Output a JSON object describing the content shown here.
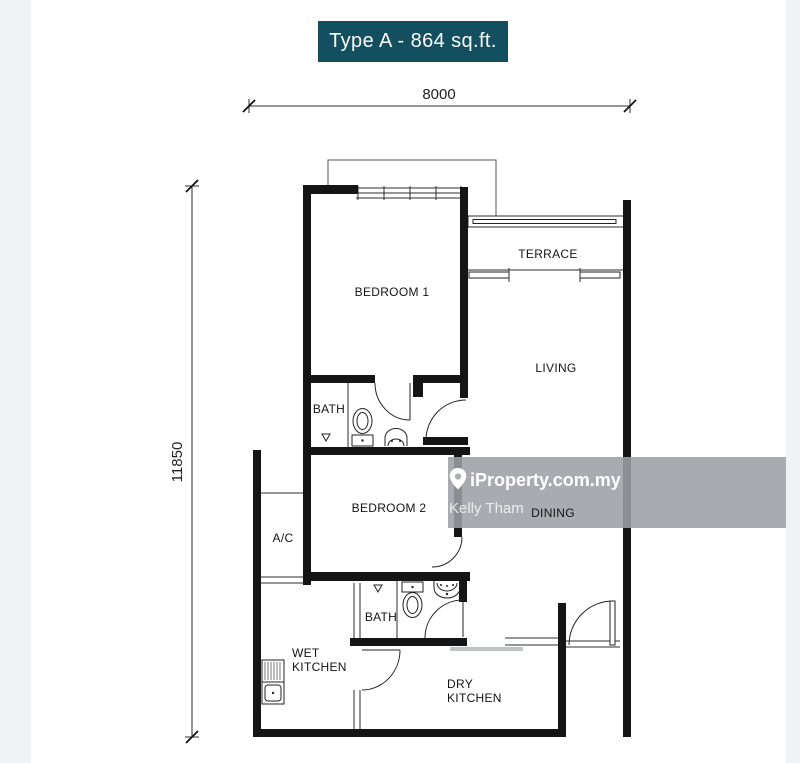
{
  "page": {
    "background_color": "#ffffff",
    "gutter_color": "#f1f2f4"
  },
  "title_badge": {
    "label": "Type A - 864 sq.ft.",
    "background_color": "#134f5e",
    "text_color": "#ffffff"
  },
  "dimension_labels": {
    "top_width": "8000",
    "left_height": "11850"
  },
  "plan_labels": {
    "bedroom_1": "BEDROOM 1",
    "terrace": "TERRACE",
    "living": "LIVING",
    "bath_1": "BATH",
    "bedroom_2": "BEDROOM 2",
    "ac_ledge": "A/C",
    "dining": "DINING",
    "wet_kitchen_line_1": "WET",
    "wet_kitchen_line_2": "KITCHEN",
    "bath_2": "BATH",
    "dry_kitchen_line_1": "DRY",
    "dry_kitchen_line_2": "KITCHEN"
  },
  "watermark": {
    "brand": "iProperty.com.my",
    "agent_name": "Kelly Tham",
    "icon": "location-pin-icon",
    "band_color": "rgba(156,159,164,0.88)"
  }
}
